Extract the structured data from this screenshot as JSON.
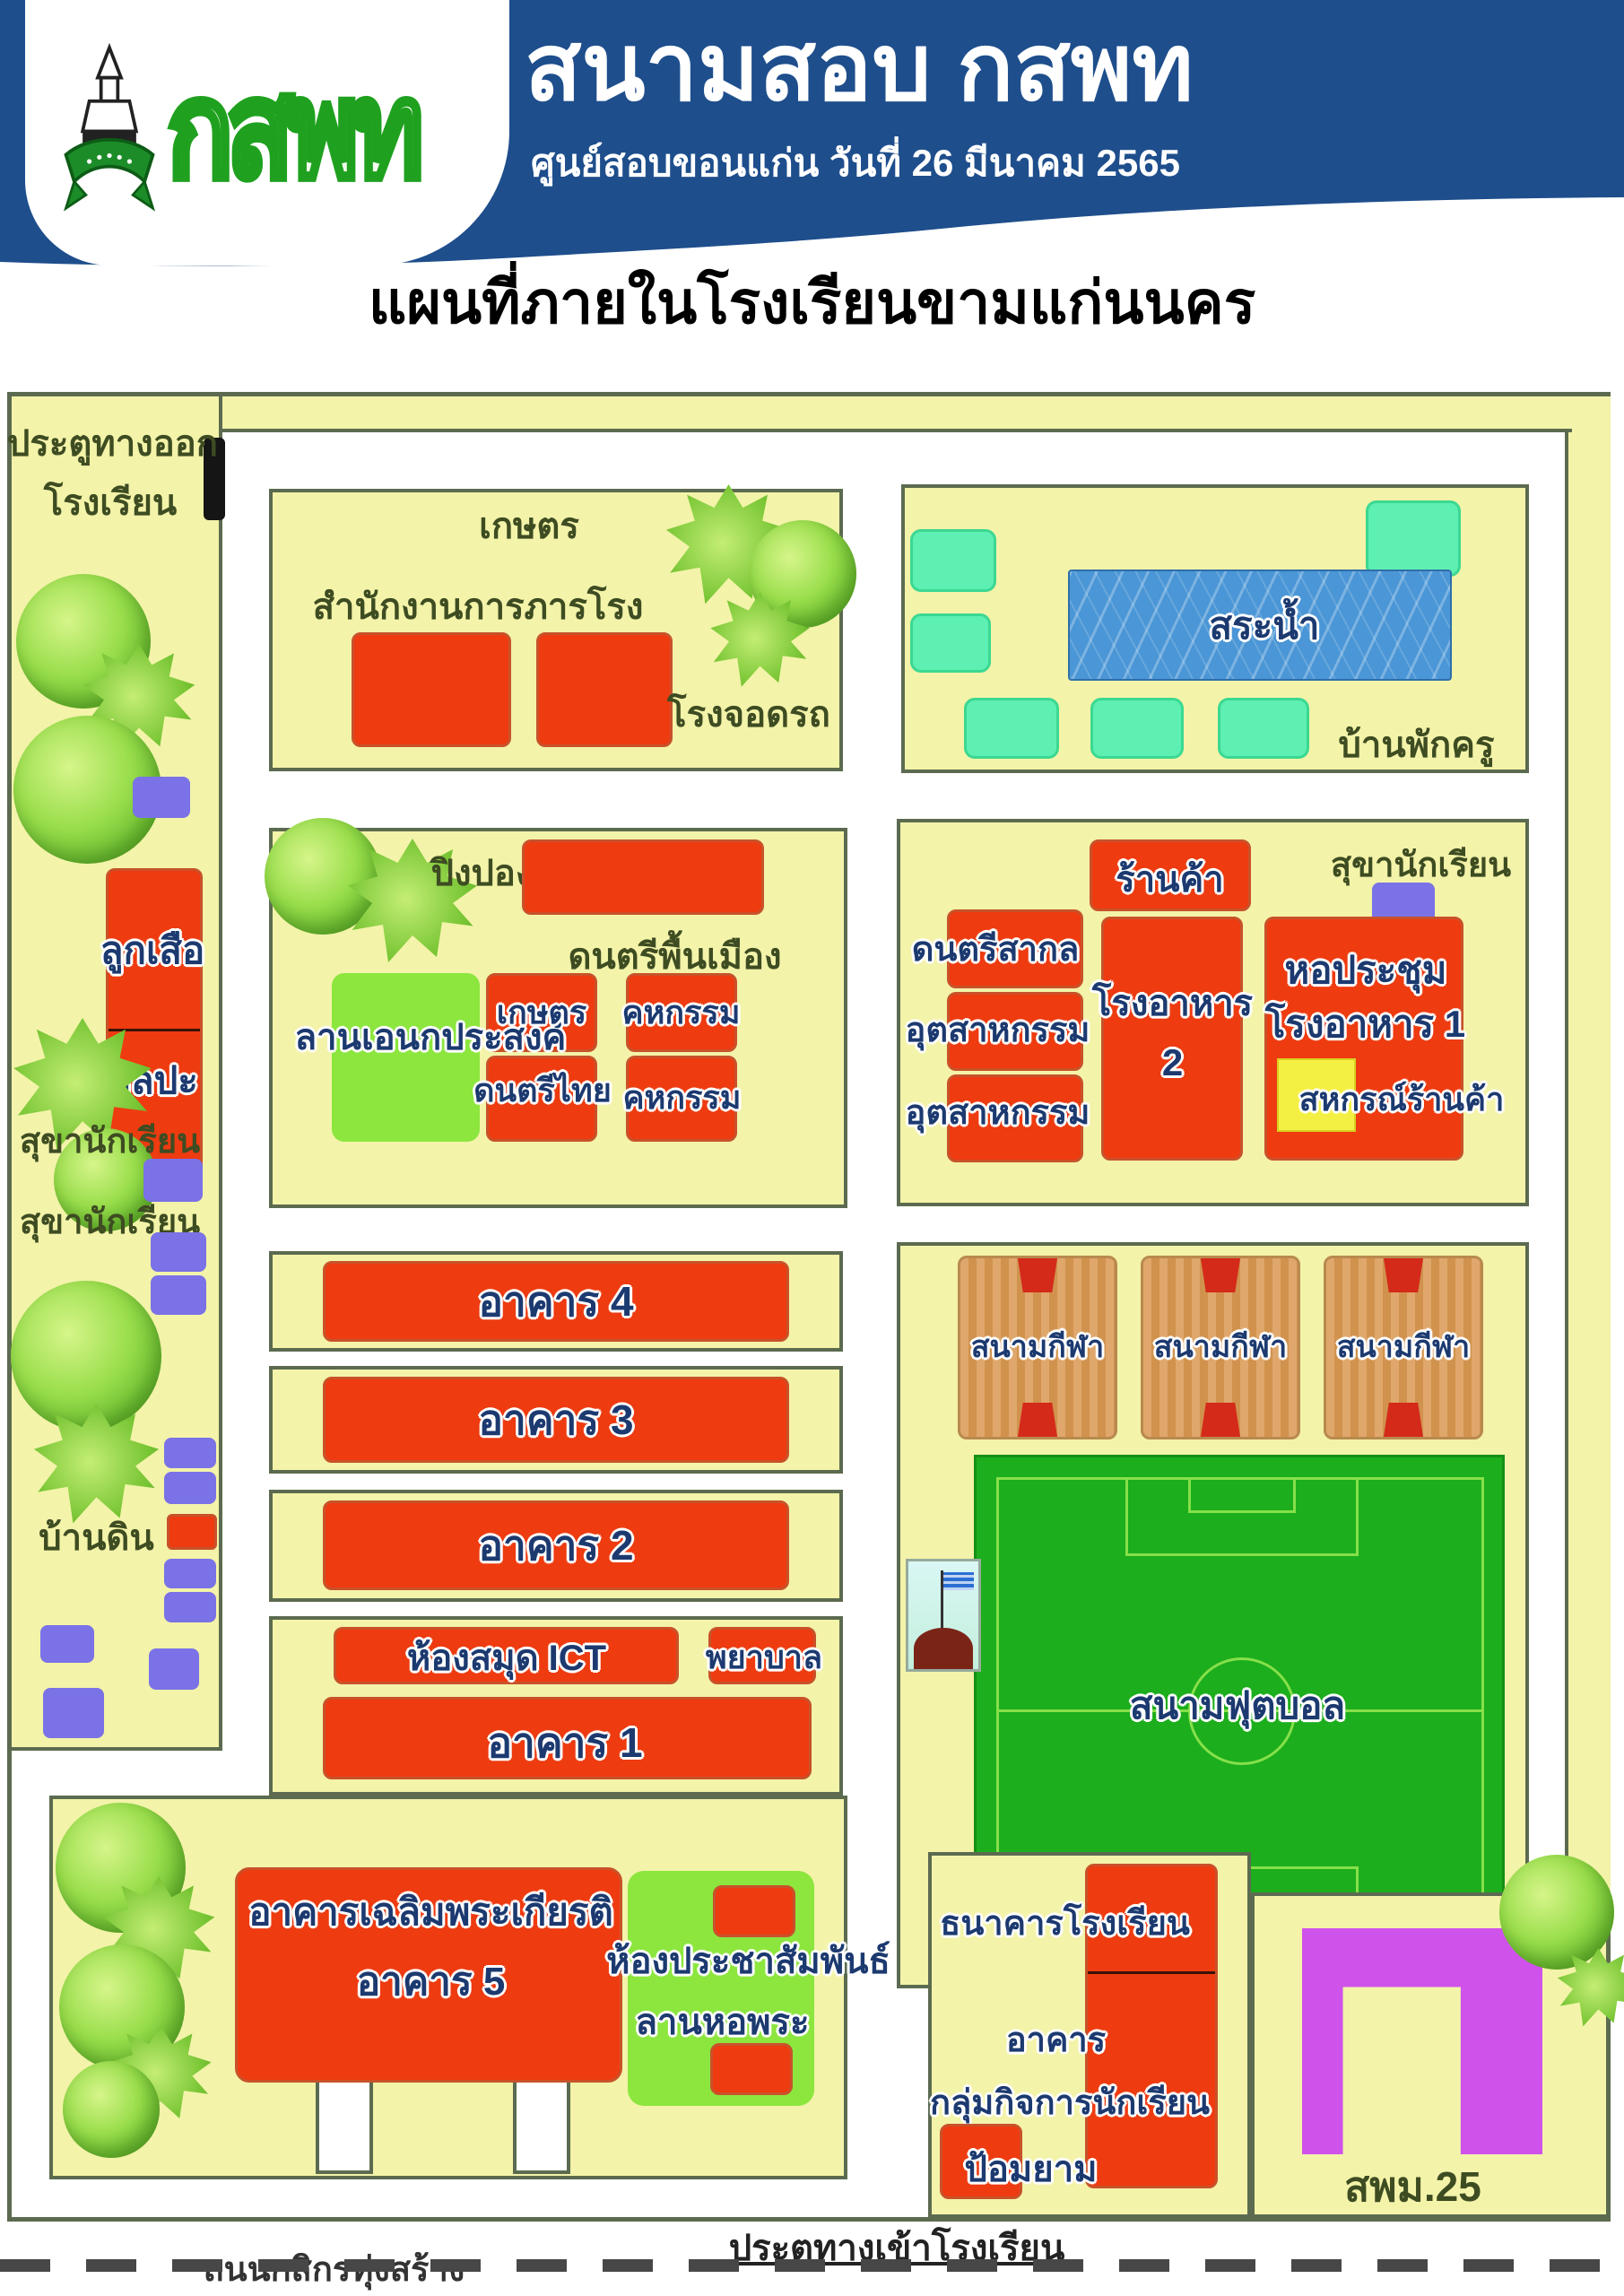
{
  "header": {
    "title": "สนามสอบ กสพท",
    "subtitle": "ศูนย์สอบขอนแก่น วันที่ 26 มีนาคม 2565",
    "logo_text": "กสพท"
  },
  "page_title": "แผนที่ภายในโรงเรียนขามแก่นนคร",
  "map": {
    "exit_gate_line1": "ประตูทางออก",
    "exit_gate_line2": "โรงเรียน",
    "agriculture": "เกษตร",
    "janitor_office": "สำนักงานการภารโรง",
    "parking": "โรงจอดรถ",
    "pond": "สระน้ำ",
    "teacher_house": "บ้านพักครู",
    "ping_pong": "ปิงปอง",
    "folk_music": "ดนตรีพื้นเมือง",
    "multipurpose_court": "ลานเอนกประสงค์",
    "agriculture2": "เกษตร",
    "thai_music": "ดนตรีไทย",
    "home_econ1": "คหกรรม",
    "home_econ2": "คหกรรม",
    "scouts": "ลูกเสือ",
    "art": "ศิลปะ",
    "student_toilet1": "สุขานักเรียน",
    "student_toilet2": "สุขานักเรียน",
    "student_toilet3": "สุขานักเรียน",
    "earth_house": "บ้านดิน",
    "shop": "ร้านค้า",
    "intl_music": "ดนตรีสากล",
    "industry1": "อุตสาหกรรม",
    "industry2": "อุตสาหกรรม",
    "canteen2_line1": "โรงอาหาร",
    "canteen2_line2": "2",
    "hall_line1": "หอประชุม",
    "hall_line2": "โรงอาหาร 1",
    "coop_shop": "สหกรณ์ร้านค้า",
    "sport_court1": "สนามกีฬา",
    "sport_court2": "สนามกีฬา",
    "sport_court3": "สนามกีฬา",
    "football_field": "สนามฟุตบอล",
    "building4": "อาคาร 4",
    "building3": "อาคาร 3",
    "building2": "อาคาร 2",
    "building1": "อาคาร 1",
    "ict_library": "ห้องสมุด ICT",
    "nurse": "พยาบาล",
    "building5_line1": "อาคารเฉลิมพระเกียรติ",
    "building5_line2": "อาคาร 5",
    "pr_room": "ห้องประชาสัมพันธ์",
    "buddha_court": "ลานหอพระ",
    "school_bank": "ธนาคารโรงเรียน",
    "building_word": "อาคาร",
    "student_affairs": "กลุ่มกิจการนักเรียน",
    "guard_post": "ป้อมยาม",
    "spm25": "สพม.25",
    "entrance_gate": "ประตูทางเข้าโรงเรียน",
    "road_name": "ถนนกสิกรทุ่งสร้าง"
  },
  "colors": {
    "header_navy": "#1e4e8c",
    "map_yellow": "#f3f3a9",
    "building_red": "#ee3b10",
    "teal_house": "#5df0b2",
    "toilet_purple": "#7a72e6",
    "field_green": "#1cae1c",
    "spm_purple": "#cf52ea"
  }
}
